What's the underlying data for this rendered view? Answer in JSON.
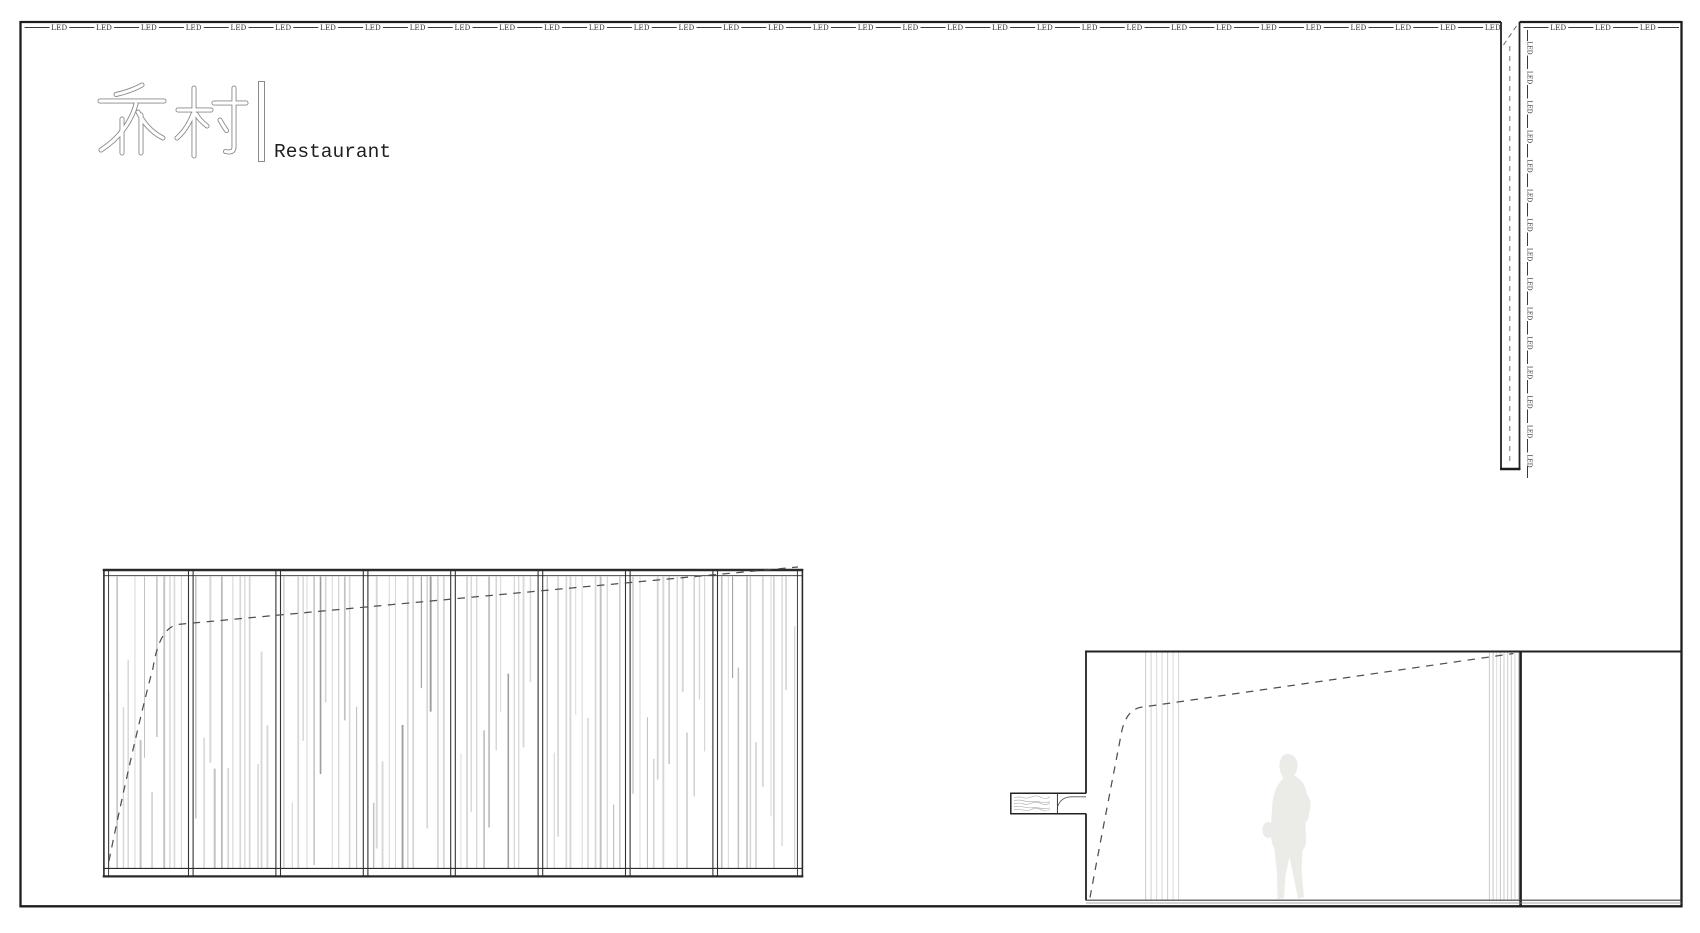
{
  "brand": {
    "hanzi": "乔村",
    "divider": "|",
    "latin": "Restaurant"
  },
  "led": {
    "label": "LED",
    "top_left_count": 33,
    "top_right_count": 3,
    "column_mark_count": 15
  },
  "elevation_panel": {
    "sections": 8,
    "slats_per_section": 13
  },
  "section_view": {
    "person_figure": "walking person silhouette",
    "shelf": "wood shelf"
  },
  "colors": {
    "background": "#ffffff",
    "border": "#1d1d1d",
    "line": "#3a3a3a",
    "led_text": "#2b2b2b",
    "dash": "#4f4f4f",
    "slat_light": "#d7d7d7",
    "slat_mid": "#c2c2c2",
    "slat_dark": "#9e9e9e",
    "curtain": "#cccccc",
    "silhouette": "#ebebe8",
    "logo_outline": "#8a8a8a",
    "logo_text": "#1e1e1e"
  }
}
